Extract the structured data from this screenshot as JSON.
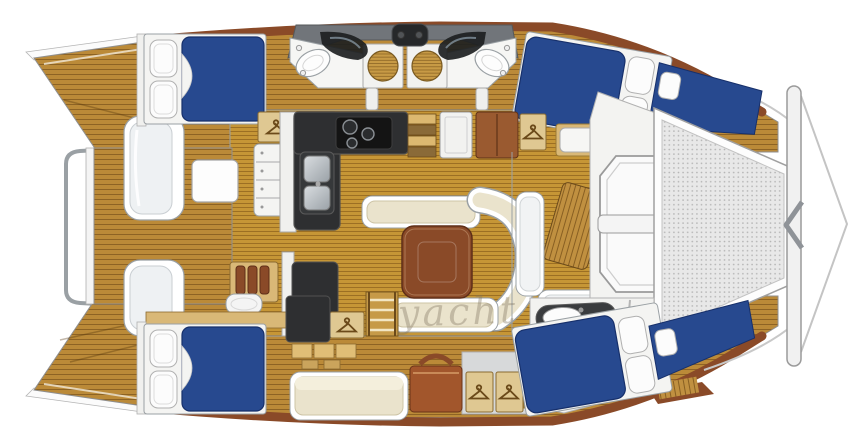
{
  "watermark": {
    "text": "yacht"
  },
  "palette": {
    "teak": "#bb8a38",
    "salon-teak": "#c69636",
    "bed-blue": "#27498f",
    "bed-blue-dark": "#17306b",
    "counter-dark": "#2e2f31",
    "wood-red": "#8a4a28",
    "cabinet-brown": "#9a5a30",
    "locker-tan": "#dfc892",
    "cushion-cream": "#eae3cc",
    "hull-white": "#f4f4f2",
    "mesh-gray": "#e8e8e8",
    "outline-gray": "#9aa0a4",
    "flybridge-gray": "#71757a"
  }
}
